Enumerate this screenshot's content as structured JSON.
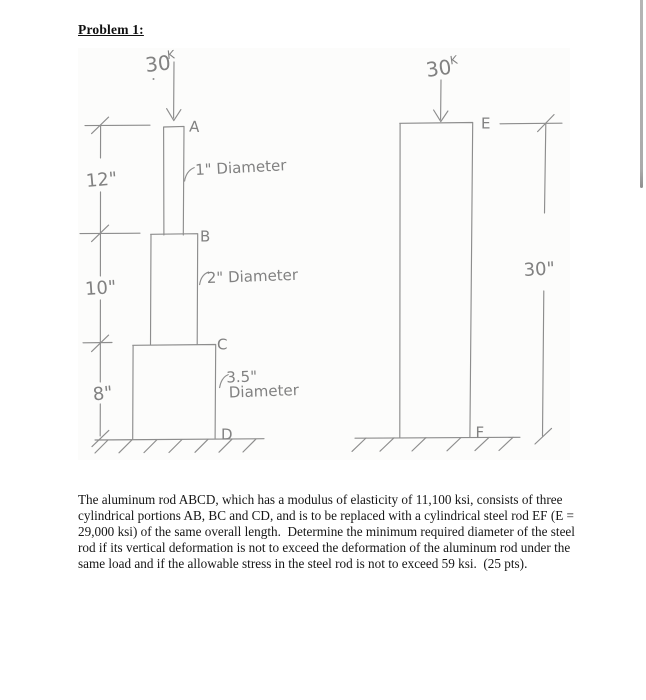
{
  "document": {
    "title": "Problem 1:",
    "body_lines": [
      "The aluminum rod ABCD, which has a modulus of elasticity of 11,100 ksi, consists of three",
      "cylindrical portions AB, BC and CD, and is to be replaced with a cylindrical steel rod EF (E =",
      "29,000 ksi) of the same overall length.  Determine the minimum required diameter of the steel",
      "rod if its vertical deformation is not to exceed the deformation of the aluminum rod under the",
      "same load and if the allowable stress in the steel rod is not to exceed 59 ksi.  (25 pts)."
    ]
  },
  "sketch": {
    "left_figure": {
      "load": "30",
      "load_sup": "K",
      "point_a": "A",
      "point_b": "B",
      "point_c": "C",
      "point_d": "D",
      "dim_12": "12\"",
      "dim_10": "10\"",
      "dim_8": "8\"",
      "dia_ab": "1\" Diameter",
      "dia_bc": "2\" Diameter",
      "dia_cd_line1": "3.5\"",
      "dia_cd_line2": "Diameter"
    },
    "right_figure": {
      "load": "30",
      "load_sup": "K",
      "point_e": "E",
      "point_f": "F",
      "dim_30": "30\""
    }
  },
  "colors": {
    "pencil": "#8d8d8d",
    "typed_text": "#161616",
    "scrollbar": "#ababab",
    "paper": "#ffffff"
  }
}
